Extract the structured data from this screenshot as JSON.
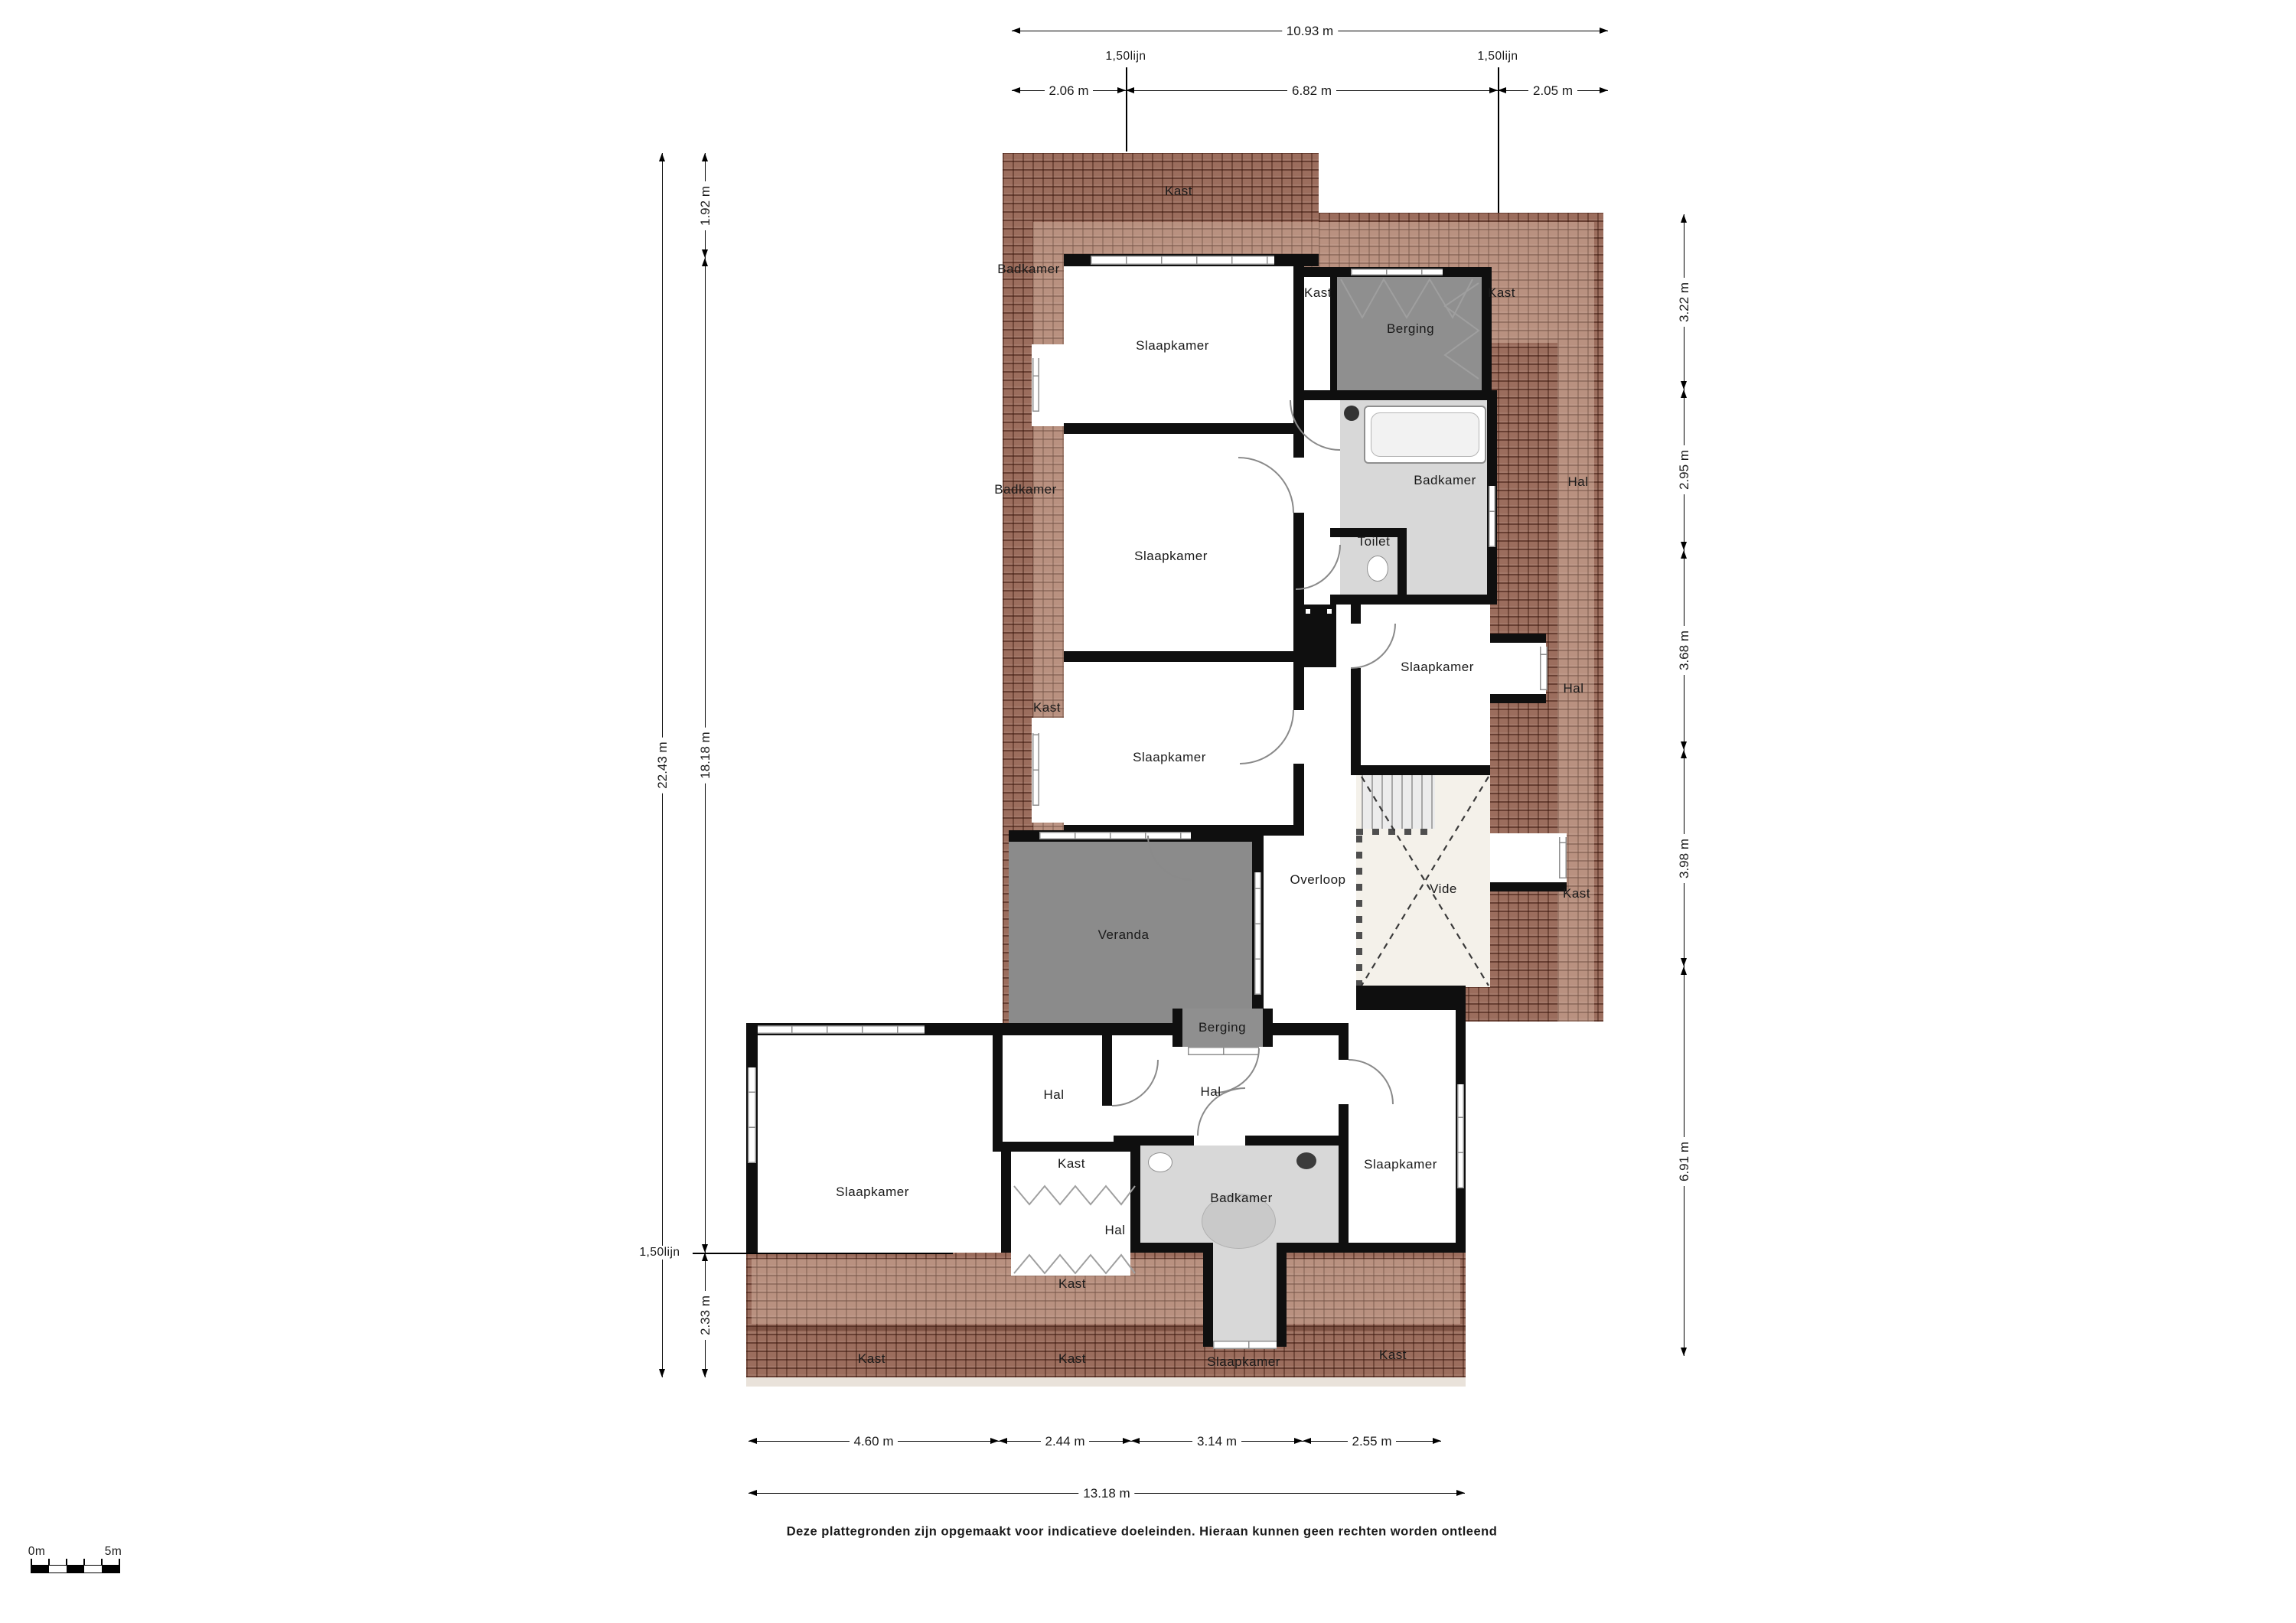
{
  "colors": {
    "roof": "#9b6d5d",
    "wall": "#0f0f0f",
    "room": "#ffffff",
    "storage_gray": "#8f8f8f",
    "bath_gray": "#d8d8d8",
    "vide_cream": "#f4f1ea"
  },
  "dims": {
    "top": {
      "total": "10.93 m",
      "segments": [
        "2.06 m",
        "6.82 m",
        "2.05 m"
      ],
      "lijn": "1,50lijn"
    },
    "left": {
      "total": "22.43 m",
      "segments": [
        "1.92 m",
        "18.18 m",
        "2.33 m"
      ],
      "lijn": "1,50lijn"
    },
    "right": {
      "segments": [
        "3.22 m",
        "2.95 m",
        "3.68 m",
        "3.98 m",
        "6.91 m"
      ]
    },
    "bottom": {
      "total": "13.18 m",
      "segments": [
        "4.60 m",
        "2.44 m",
        "3.14 m",
        "2.55 m"
      ]
    }
  },
  "scalebar": {
    "start": "0m",
    "end": "5m"
  },
  "footer": "Deze plattegronden zijn opgemaakt voor indicatieve doeleinden. Hieraan kunnen geen rechten worden ontleend",
  "labels": {
    "kast_top": "Kast",
    "badkamer_left_1": "Badkamer",
    "slaapkamer_1": "Slaapkamer",
    "kast_mid": "Kast",
    "berging_1": "Berging",
    "kast_right_1": "Kast",
    "badkamer_1": "Badkamer",
    "hal_right_1": "Hal",
    "badkamer_left_2": "Badkamer",
    "toilet": "Toilet",
    "slaapkamer_2": "Slaapkamer",
    "slaapkamer_4": "Slaapkamer",
    "hal_right_2": "Hal",
    "kast_left": "Kast",
    "slaapkamer_3": "Slaapkamer",
    "overloop": "Overloop",
    "vide": "Vide",
    "kast_right_2": "Kast",
    "veranda": "Veranda",
    "berging_2": "Berging",
    "hal_1": "Hal",
    "hal_2": "Hal",
    "slaapkamer_5": "Slaapkamer",
    "kast_2": "Kast",
    "hal_3": "Hal",
    "badkamer_2": "Badkamer",
    "slaapkamer_6": "Slaapkamer",
    "kast_roof_center": "Kast",
    "kast_roof_left": "Kast",
    "kast_roof_mid": "Kast",
    "slaapkamer_roof": "Slaapkamer",
    "kast_roof_right": "Kast"
  }
}
